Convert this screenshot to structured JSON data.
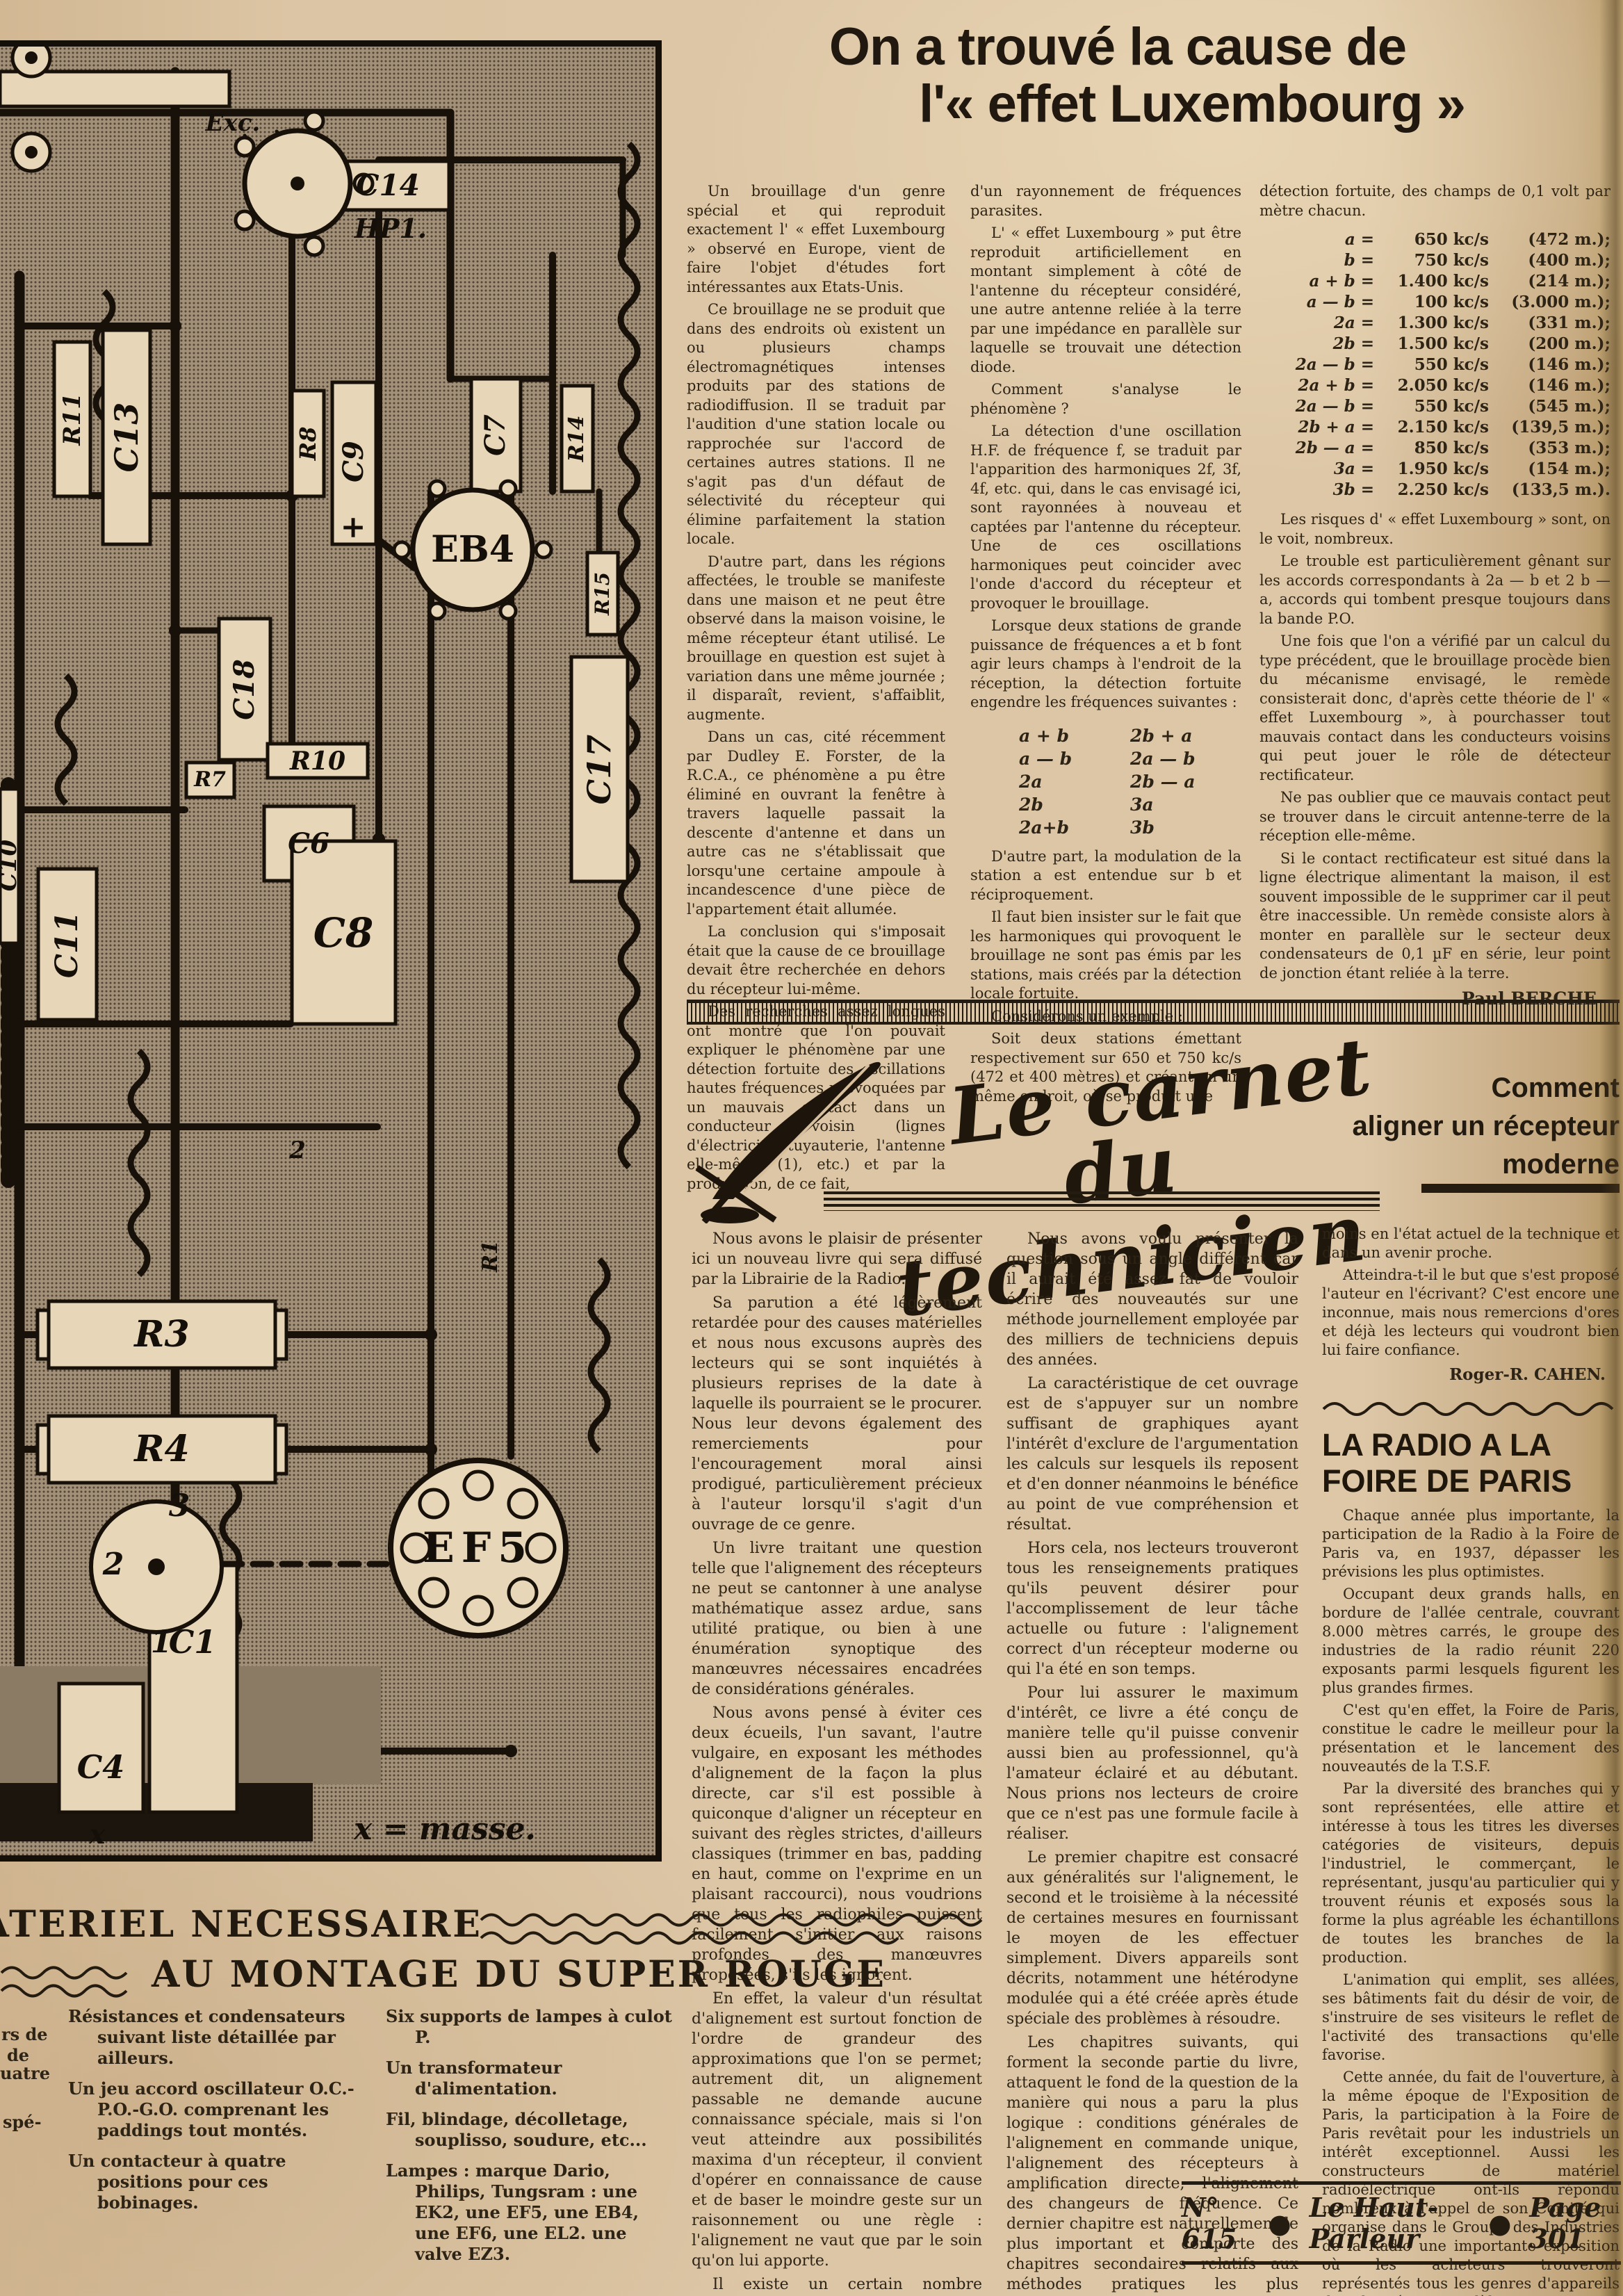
{
  "diagram": {
    "labels": {
      "exc": "Exc.",
      "c14": "C14",
      "hp1": "HP1.",
      "r11": "R11",
      "c13": "C13",
      "r8": "R8",
      "c9": "C9",
      "plus": "+",
      "c7": "C7",
      "r14": "R14",
      "eb4": "EB4",
      "r15": "R15",
      "c18": "C18",
      "c17": "C17",
      "r10": "R10",
      "r7": "R7",
      "c6": "C6",
      "c8": "C8",
      "c10": "C10",
      "c11": "C11",
      "r3": "R3",
      "r4": "R4",
      "r1": "R1",
      "n2": "2",
      "pin3": "3",
      "pin2": "2",
      "pin1": "1",
      "ef5": "EF5",
      "c4": "C4",
      "c1": "C1",
      "x": "x"
    },
    "caption": "x = masse."
  },
  "lux": {
    "title1": "On a trouvé la cause de",
    "title2": "l'« effet Luxembourg »",
    "col1": [
      "Un brouillage d'un genre spécial et qui reproduit exactement l' « effet Luxembourg » observé en Europe, vient de faire l'objet d'études fort intéressantes aux Etats-Unis.",
      "Ce brouillage ne se produit que dans des endroits où existent un ou plusieurs champs électromagnétiques intenses produits par des stations de radiodiffusion. Il se traduit par l'audition d'une station locale ou rapprochée sur l'accord de certaines autres stations. Il ne s'agit pas d'un défaut de sélectivité du récepteur qui élimine parfaitement la station locale.",
      "D'autre part, dans les régions affectées, le trouble se manifeste dans une maison et ne peut être observé dans la maison voisine, le même récepteur étant utilisé. Le brouillage en question est sujet à variation dans une même journée ; il disparaît, revient, s'affaiblit, augmente.",
      "Dans un cas, cité récemment par Dudley E. Forster, de la R.C.A., ce phénomène a pu être éliminé en ouvrant la fenêtre à travers laquelle passait la descente d'antenne et dans un autre cas ne s'établissait que lorsqu'une certaine ampoule à incandescence d'une pièce de l'appartement était allumée.",
      "La conclusion qui s'imposait était que la cause de ce brouillage devait être recherchée en dehors du récepteur lui-même.",
      "Des recherches assez longues ont montré que l'on pouvait expliquer le phénomène par une détection fortuite des oscillations hautes fréquences provoquées par un mauvais contact dans un conducteur voisin (lignes d'électricité, tuyauterie, l'antenne elle-même (1), etc.) et par la production, de ce fait,"
    ],
    "col2_top": [
      "d'un rayonnement de fréquences parasites.",
      "L' « effet Luxembourg » put être reproduit artificiellement en montant simplement à côté de l'antenne du récepteur considéré, une autre antenne reliée à la terre par une impédance en parallèle sur laquelle se trouvait une détection diode.",
      "Comment s'analyse le phénomène ?",
      "La détection d'une oscillation H.F. de fréquence f, se traduit par l'apparition des harmoniques 2f, 3f, 4f, etc. qui, dans le cas envisagé ici, sont rayonnées à nouveau et captées par l'antenne du récepteur. Une de ces oscillations harmoniques peut coincider avec l'onde d'accord du récepteur et provoquer le brouillage.",
      "Lorsque deux stations de grande puissance de fréquences a et b font agir leurs champs à l'endroit de la réception, la détection fortuite engendre les fréquences suivantes :"
    ],
    "formulas_left": [
      "a + b",
      "a — b",
      "2a",
      "2b",
      "2a+b"
    ],
    "formulas_right": [
      "2b + a",
      "2a — b",
      "2b — a",
      "3a",
      "3b"
    ],
    "col2_bottom": [
      "D'autre part, la modulation de la station a est entendue sur b et réciproquement.",
      "Il faut bien insister sur le fait que les harmoniques qui provoquent le brouillage ne sont pas émis par les stations, mais créés par la détection locale fortuite.",
      "Considérons un exemple :",
      "Soit deux stations émettant respectivement sur 650 et 750 kc/s (472 et 400 mètres) et créant en un même endroit, où se produit une"
    ],
    "col3_top": [
      "détection fortuite, des champs de 0,1 volt par mètre chacun."
    ],
    "freq_table": [
      {
        "f": "a =",
        "kc": "650 kc/s",
        "m": "(472 m.);"
      },
      {
        "f": "b =",
        "kc": "750 kc/s",
        "m": "(400 m.);"
      },
      {
        "f": "a + b =",
        "kc": "1.400 kc/s",
        "m": "(214 m.);"
      },
      {
        "f": "a — b =",
        "kc": "100 kc/s",
        "m": "(3.000 m.);"
      },
      {
        "f": "2a =",
        "kc": "1.300 kc/s",
        "m": "(331 m.);"
      },
      {
        "f": "2b =",
        "kc": "1.500 kc/s",
        "m": "(200 m.);"
      },
      {
        "f": "2a — b =",
        "kc": "550 kc/s",
        "m": "(146 m.);"
      },
      {
        "f": "2a + b =",
        "kc": "2.050 kc/s",
        "m": "(146 m.);"
      },
      {
        "f": "2a — b =",
        "kc": "550 kc/s",
        "m": "(545 m.);"
      },
      {
        "f": "2b + a =",
        "kc": "2.150 kc/s",
        "m": "(139,5 m.);"
      },
      {
        "f": "2b — a =",
        "kc": "850 kc/s",
        "m": "(353 m.);"
      },
      {
        "f": "3a =",
        "kc": "1.950 kc/s",
        "m": "(154 m.);"
      },
      {
        "f": "3b =",
        "kc": "2.250 kc/s",
        "m": "(133,5 m.)."
      }
    ],
    "col3": [
      "Les risques d' « effet Luxembourg » sont, on le voit, nombreux.",
      "Le trouble est particulièrement gênant sur les accords correspondants à 2a — b et 2 b — a, accords qui tombent presque toujours dans la bande P.O.",
      "Une fois que l'on a vérifié par un calcul du type précédent, que le brouillage procède bien du mécanisme envisagé, le remède consisterait donc, d'après cette théorie de l' « effet Luxembourg », à pourchasser tout mauvais contact dans les conducteurs voisins qui peut jouer le rôle de détecteur rectificateur.",
      "Ne pas oublier que ce mauvais contact peut se trouver dans le circuit antenne-terre de la réception elle-même.",
      "Si le contact rectificateur est situé dans la ligne électrique alimentant la maison, il est souvent impossible de le supprimer car il peut être inaccessible. Un remède consiste alors à monter en parallèle sur le secteur deux condensateurs de 0,1 µF en série, leur point de jonction étant reliée à la terre."
    ],
    "signature": "Paul BERCHE"
  },
  "carnet": {
    "title1": "Le carnet",
    "title2": "du technicien",
    "subtitle_lines": [
      "Comment",
      "aligner un récepteur",
      "moderne"
    ],
    "colA": [
      "Nous avons le plaisir de présenter ici un nouveau livre qui sera diffusé par la Librairie de la Radio.",
      "Sa parution a été légèrement retardée pour des causes matérielles et nous nous excusons auprès des lecteurs qui se sont inquiétés à plusieurs reprises de la date à laquelle ils pourraient se le procurer. Nous leur devons également des remerciements pour l'encouragement moral ainsi prodigué, particulièrement précieux à l'auteur lorsqu'il s'agit d'un ouvrage de ce genre.",
      "Un livre traitant une question telle que l'alignement des récepteurs ne peut se cantonner à une analyse mathématique assez ardue, sans utilité pratique, ou bien à une énumération synoptique des manœuvres nécessaires encadrées de considérations générales.",
      "Nous avons pensé à éviter ces deux écueils, l'un savant, l'autre vulgaire, en exposant les méthodes d'alignement de la façon la plus directe, car s'il est possible à quiconque d'aligner un récepteur en suivant des règles strictes, d'ailleurs classiques (trimmer en bas, padding en haut, comme on l'exprime en un plaisant raccourci), nous voudrions que tous les radiophiles puissent facilement s'initier aux raisons profondes des manœuvres proposées, s'ils les ignorent.",
      "En effet, la valeur d'un résultat d'alignement est surtout fonction de l'ordre de grandeur des approximations que l'on se permet; autrement dit, un alignement passable ne demande aucune connaissance spéciale, mais si l'on veut atteindre aux possibilités maxima d'un récepteur, il convient d'opérer en connaissance de cause et de baser le moindre geste sur un raisonnement ou une règle : l'alignement ne vaut que par le soin qu'on lui apporte.",
      "Il existe un certain nombre d'ouvrages traitant cette question, écrits par des confrères de valeur, qui pourraient faire songer à un double emploi de notre exposé."
    ],
    "colB": [
      "Nous avons voulu présenter la question sous un angle différent car il aurait été assez fat de vouloir écrire des nouveautés sur une méthode journellement employée par des milliers de techniciens depuis des années.",
      "La caractéristique de cet ouvrage est de s'appuyer sur un nombre suffisant de graphiques ayant l'intérêt d'exclure de l'argumentation les calculs sur lesquels ils reposent et d'en donner néanmoins le bénéfice au point de vue compréhension et résultat.",
      "Hors cela, nos lecteurs trouveront tous les renseignements pratiques qu'ils peuvent désirer pour l'accomplissement de leur tâche actuelle ou future : l'alignement correct d'un récepteur moderne ou qui l'a été en son temps.",
      "Pour lui assurer le maximum d'intérêt, ce livre a été conçu de manière telle qu'il puisse convenir aussi bien au professionnel, qu'à l'amateur éclairé et au débutant. Nous prions nos lecteurs de croire que ce n'est pas une formule facile à réaliser.",
      "Le premier chapitre est consacré aux généralités sur l'alignement, le second et le troisième à la nécessité de certaines mesures en fournissant le moyen de les effectuer simplement. Divers appareils sont décrits, notamment une hétérodyne modulée qui a été créée après étude spéciale des problèmes à résoudre.",
      "Les chapitres suivants, qui forment la seconde partie du livre, attaquent le fond de la question de la manière qui nous a paru la plus logique : conditions générales de l'alignement en commande unique, l'alignement des récepteurs à amplification directe, l'alignement des changeurs de fréquence. Ce dernier chapitre est naturellement le plus important et comporte des chapitres secondaires relatifs aux méthodes pratiques les plus éprouvées.",
      "Ce livre épuise-t-il la question ? Nous le pensons sincèrement, du"
    ],
    "colC": [
      "moins en l'état actuel de la technique et dans un avenir proche.",
      "Atteindra-t-il le but que s'est proposé l'auteur en l'écrivant? C'est encore une inconnue, mais nous remercions d'ores et déjà les lecteurs qui voudront bien lui faire confiance."
    ],
    "signature": "Roger-R. CAHEN."
  },
  "foire": {
    "title": "LA RADIO A LA FOIRE DE PARIS",
    "paragraphs": [
      "Chaque année plus importante, la participation de la Radio à la Foire de Paris va, en 1937, dépasser les prévisions les plus optimistes.",
      "Occupant deux grands halls, en bordure de l'allée centrale, couvrant 8.000 mètres carrés, le groupe des industries de la radio réunit 220 exposants parmi lesquels figurent les plus grandes firmes.",
      "C'est qu'en effet, la Foire de Paris, constitue le cadre le meilleur pour la présentation et le lancement des nouveautés de la T.S.F.",
      "Par la diversité des branches qui y sont représentées, elle attire et intéresse à tous les titres les diverses catégories de visiteurs, depuis l'industriel, le commerçant, le représentant, jusqu'au particulier qui y trouvent réunis et exposés sous la forme la plus agréable les échantillons de toutes les branches de la production.",
      "L'animation qui emplit, ses allées, ses bâtiments fait du désir de voir, de s'instruire de ses visiteurs le reflet de l'activité des transactions qu'elle favorise.",
      "Cette année, du fait de l'ouverture, à la même époque de l'Exposition de Paris, la participation à la Foire de Paris revêtait pour les industriels un intérêt exceptionnel. Aussi les constructeurs de matériel radioélectrique ont-ils répondu nombreux à l'appel de son Comité qui organise dans le Groupe des Industries de la Radio une importante exposition où les acheteurs trouveront représentés tous les genres d'appareils des plus récents modèles."
    ]
  },
  "materiel": {
    "title1": "MATERIEL NECESSAIRE",
    "title2": "AU MONTAGE DU SUPER ROUGE",
    "left_items": [
      "Résistances et condensateurs suivant liste détaillée par ailleurs.",
      "Un jeu accord oscillateur O.C.-P.O.-G.O. comprenant les paddings tout montés.",
      "Un contacteur à quatre positions pour ces bobinages."
    ],
    "right_items": [
      "Six supports de lampes à culot P.",
      "Un transformateur d'alimentation.",
      "Fil, blindage, décolletage, souplisso, soudure, etc...",
      "Lampes : marque Dario, Philips, Tungsram : une EK2, une EF5, une EB4, une EF6, une EL2. une valve EZ3."
    ]
  },
  "margin_fragments": [
    "rs de",
    "de",
    "uatre",
    "spé-"
  ],
  "footer": {
    "issue": "N° 615",
    "magazine": "Le Haut-Parleur",
    "page": "Page 301"
  }
}
